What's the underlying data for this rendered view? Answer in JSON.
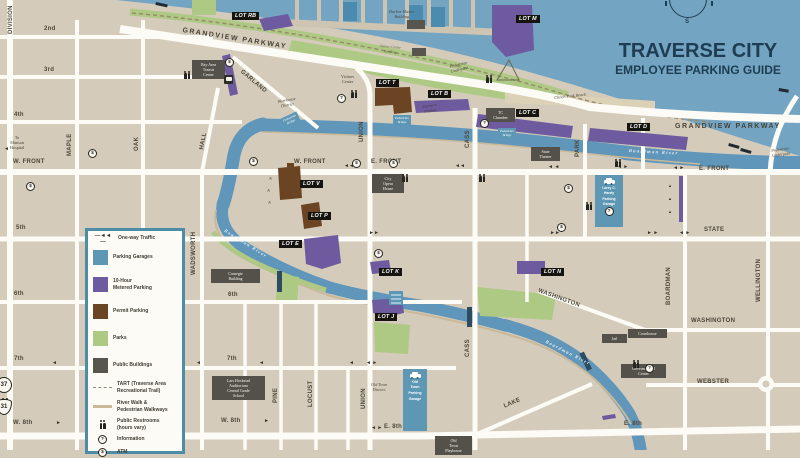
{
  "title": {
    "line1": "TRAVERSE CITY",
    "line2": "EMPLOYEE PARKING GUIDE",
    "compass_south": "S"
  },
  "colors": {
    "land": "#d4cbbb",
    "bay": "#73a4c2",
    "river": "#6096ba",
    "street": "#fcfbf6",
    "parking_garage": "#5d97b4",
    "metered_parking": "#6e5a9e",
    "permit_parking": "#6b4423",
    "park": "#aec983",
    "public_building": "#57554e",
    "lot_label_box": "#15140f",
    "title_text": "#1e3d52",
    "legend_border": "#4d8ca6",
    "river_walk": "#c9b998"
  },
  "legend": {
    "items": [
      {
        "key": "one-way-traffic",
        "lines": [
          "One-way Traffic"
        ],
        "swatch": "glyph",
        "glyph": "—◄◄—",
        "h": 11
      },
      {
        "key": "parking-garages",
        "lines": [
          "Parking Garages"
        ],
        "swatch": "rect",
        "color": "#5d97b4",
        "h": 27
      },
      {
        "key": "metered-parking",
        "lines": [
          "10-Hour",
          "Metered Parking"
        ],
        "swatch": "rect",
        "color": "#6e5a9e",
        "h": 27
      },
      {
        "key": "permit-parking",
        "lines": [
          "Permit Parking"
        ],
        "swatch": "rect",
        "color": "#6b4423",
        "h": 27
      },
      {
        "key": "parks",
        "lines": [
          "Parks"
        ],
        "swatch": "rect",
        "color": "#aec983",
        "h": 27
      },
      {
        "key": "public-buildings",
        "lines": [
          "Public Buildings"
        ],
        "swatch": "rect",
        "color": "#57554e",
        "h": 26
      },
      {
        "key": "tart-trail",
        "lines": [
          "TART (Traverse Area",
          "Recreational Trail)"
        ],
        "swatch": "dash",
        "h": 19
      },
      {
        "key": "river-walk",
        "lines": [
          "River Walk &",
          "Pedestrian Walkways"
        ],
        "swatch": "line",
        "h": 19
      },
      {
        "key": "public-restrooms",
        "lines": [
          "Public Restrooms",
          "(hours vary)"
        ],
        "swatch": "restroom",
        "h": 17
      },
      {
        "key": "information",
        "lines": [
          "Information"
        ],
        "swatch": "info",
        "glyph": "?",
        "h": 13
      },
      {
        "key": "atm",
        "lines": [
          "ATM"
        ],
        "swatch": "atm",
        "glyph": "$",
        "h": 12
      }
    ]
  },
  "map": {
    "icon_glyphs": {
      "info": "?",
      "atm": "$"
    },
    "labels": [
      {
        "n": "street-label-2nd",
        "c": "st",
        "t": "2nd",
        "x": 44,
        "y": 26
      },
      {
        "n": "street-label-3rd",
        "c": "st",
        "t": "3rd",
        "x": 44,
        "y": 67
      },
      {
        "n": "street-label-4th",
        "c": "st",
        "t": "4th",
        "x": 14,
        "y": 112
      },
      {
        "n": "street-label-w-front-left",
        "c": "st",
        "t": "W. FRONT",
        "x": 13,
        "y": 159
      },
      {
        "n": "street-label-w-front",
        "c": "st",
        "t": "W. FRONT",
        "x": 294,
        "y": 159
      },
      {
        "n": "street-label-e-front",
        "c": "st",
        "t": "E. FRONT",
        "x": 371,
        "y": 159
      },
      {
        "n": "street-label-e-front-right",
        "c": "st",
        "t": "E. FRONT",
        "x": 699,
        "y": 166
      },
      {
        "n": "street-label-5th",
        "c": "st",
        "t": "5th",
        "x": 16,
        "y": 225
      },
      {
        "n": "street-label-state",
        "c": "st",
        "t": "STATE",
        "x": 704,
        "y": 227
      },
      {
        "n": "street-label-6th-left",
        "c": "st",
        "t": "6th",
        "x": 14,
        "y": 291
      },
      {
        "n": "street-label-6th",
        "c": "st",
        "t": "6th",
        "x": 228,
        "y": 292
      },
      {
        "n": "street-label-7th-left",
        "c": "st",
        "t": "7th",
        "x": 14,
        "y": 356
      },
      {
        "n": "street-label-7th",
        "c": "st",
        "t": "7th",
        "x": 227,
        "y": 356
      },
      {
        "n": "street-label-w-8th-left",
        "c": "st",
        "t": "W. 8th",
        "x": 13,
        "y": 420
      },
      {
        "n": "street-label-w-8th",
        "c": "st",
        "t": "W. 8th",
        "x": 221,
        "y": 418
      },
      {
        "n": "street-label-e-8th",
        "c": "st",
        "t": "E. 8th",
        "x": 384,
        "y": 424
      },
      {
        "n": "street-label-e-8th-right",
        "c": "st",
        "t": "E. 8th",
        "x": 624,
        "y": 421
      },
      {
        "n": "street-label-grandview-diag",
        "c": "st-lg",
        "t": "GRANDVIEW PARKWAY",
        "x": 183,
        "y": 27,
        "r": 9
      },
      {
        "n": "street-label-grandview-east",
        "c": "st-lg",
        "t": "GRANDVIEW PARKWAY",
        "x": 675,
        "y": 123
      },
      {
        "n": "street-label-garland",
        "c": "st",
        "t": "GARLAND",
        "x": 243,
        "y": 69,
        "r": 40
      },
      {
        "n": "street-label-washington-diag",
        "c": "st",
        "t": "WASHINGTON",
        "x": 539,
        "y": 288,
        "r": 20
      },
      {
        "n": "street-label-washington",
        "c": "st",
        "t": "WASHINGTON",
        "x": 691,
        "y": 318
      },
      {
        "n": "street-label-webster",
        "c": "st",
        "t": "WEBSTER",
        "x": 697,
        "y": 379
      },
      {
        "n": "street-label-lake",
        "c": "st",
        "t": "LAKE",
        "x": 503,
        "y": 404,
        "r": -23
      },
      {
        "n": "street-label-division",
        "c": "st",
        "t": "DIVISION",
        "x": 8,
        "y": 34,
        "r": -90
      },
      {
        "n": "street-label-maple",
        "c": "st",
        "t": "MAPLE",
        "x": 67,
        "y": 156,
        "r": -90
      },
      {
        "n": "street-label-oak",
        "c": "st",
        "t": "OAK",
        "x": 134,
        "y": 151,
        "r": -90
      },
      {
        "n": "street-label-hall",
        "c": "st",
        "t": "HALL",
        "x": 199,
        "y": 149,
        "r": -79
      },
      {
        "n": "street-label-wadsworth",
        "c": "st",
        "t": "WADSWORTH",
        "x": 191,
        "y": 275,
        "r": -90
      },
      {
        "n": "street-label-union-north",
        "c": "st",
        "t": "UNION",
        "x": 359,
        "y": 142,
        "r": -90
      },
      {
        "n": "street-label-union-south",
        "c": "st",
        "t": "UNION",
        "x": 361,
        "y": 409,
        "r": -90
      },
      {
        "n": "street-label-cass-north",
        "c": "st",
        "t": "CASS",
        "x": 465,
        "y": 148,
        "r": -90
      },
      {
        "n": "street-label-cass-south",
        "c": "st",
        "t": "CASS",
        "x": 465,
        "y": 357,
        "r": -90
      },
      {
        "n": "street-label-park",
        "c": "st",
        "t": "PARK",
        "x": 575,
        "y": 157,
        "r": -90
      },
      {
        "n": "street-label-boardman",
        "c": "st",
        "t": "BOARDMAN",
        "x": 666,
        "y": 305,
        "r": -90
      },
      {
        "n": "street-label-wellington",
        "c": "st",
        "t": "WELLINGTON",
        "x": 756,
        "y": 302,
        "r": -90
      },
      {
        "n": "street-label-pine",
        "c": "st",
        "t": "PINE",
        "x": 273,
        "y": 403,
        "r": -90
      },
      {
        "n": "street-label-locust",
        "c": "st",
        "t": "LOCUST",
        "x": 308,
        "y": 407,
        "r": -90
      },
      {
        "n": "lot-rb-label",
        "c": "lot",
        "t": "LOT RB",
        "x": 232,
        "y": 12
      },
      {
        "n": "lot-m-label",
        "c": "lot",
        "t": "LOT M",
        "x": 516,
        "y": 15
      },
      {
        "n": "lot-t-label",
        "c": "lot",
        "t": "LOT T",
        "x": 376,
        "y": 79
      },
      {
        "n": "lot-b-label",
        "c": "lot",
        "t": "LOT B",
        "x": 428,
        "y": 90
      },
      {
        "n": "lot-c-label",
        "c": "lot",
        "t": "LOT C",
        "x": 516,
        "y": 109
      },
      {
        "n": "lot-d-label",
        "c": "lot",
        "t": "LOT D",
        "x": 627,
        "y": 123
      },
      {
        "n": "lot-v-label",
        "c": "lot",
        "t": "LOT V",
        "x": 300,
        "y": 180
      },
      {
        "n": "lot-p-label",
        "c": "lot",
        "t": "LOT P",
        "x": 308,
        "y": 212
      },
      {
        "n": "lot-e-label",
        "c": "lot",
        "t": "LOT E",
        "x": 279,
        "y": 240
      },
      {
        "n": "lot-k-label",
        "c": "lot",
        "t": "LOT K",
        "x": 379,
        "y": 268
      },
      {
        "n": "lot-j-label",
        "c": "lot",
        "t": "LOT J",
        "x": 375,
        "y": 313
      },
      {
        "n": "lot-n-label",
        "c": "lot",
        "t": "LOT N",
        "x": 541,
        "y": 268
      },
      {
        "n": "bay-area-transit-center",
        "c": "bld",
        "l": [
          "Bay Area",
          "Transit",
          "Center"
        ],
        "x": 192,
        "y": 60,
        "w": 31
      },
      {
        "n": "tc-chamber",
        "c": "bld",
        "l": [
          "TC",
          "Chamber"
        ],
        "x": 486,
        "y": 108,
        "w": 27
      },
      {
        "n": "state-theater",
        "c": "bld",
        "l": [
          "State",
          "Theater"
        ],
        "x": 531,
        "y": 147,
        "w": 27
      },
      {
        "n": "city-opera-house",
        "c": "bld",
        "l": [
          "City",
          "Opera",
          "House"
        ],
        "x": 372,
        "y": 174,
        "w": 30
      },
      {
        "n": "carnegie-building",
        "c": "bld",
        "l": [
          "Carnegie",
          "Building"
        ],
        "x": 211,
        "y": 269,
        "w": 47
      },
      {
        "n": "lars-hockstad-auditorium",
        "c": "bld",
        "l": [
          "Lars Hockstad",
          "Auditorium",
          " ",
          "Central Grade",
          "School"
        ],
        "x": 212,
        "y": 376,
        "w": 51
      },
      {
        "n": "jail",
        "c": "bld",
        "l": [
          "Jail"
        ],
        "x": 602,
        "y": 334,
        "w": 23
      },
      {
        "n": "courthouse",
        "c": "bld",
        "l": [
          "Courthouse"
        ],
        "x": 628,
        "y": 329,
        "w": 37
      },
      {
        "n": "governmental-center",
        "c": "bld",
        "l": [
          "Governmental",
          "Center"
        ],
        "x": 621,
        "y": 364,
        "w": 43
      },
      {
        "n": "old-town-playhouse",
        "c": "bld",
        "l": [
          "Old",
          "Town",
          "Playhouse"
        ],
        "x": 435,
        "y": 436,
        "w": 35
      },
      {
        "n": "larry-hardy-parking-garage",
        "c": "garage",
        "l": [
          "Larry C.",
          "Hardy",
          "Parking Garage"
        ],
        "x": 595,
        "y": 175,
        "w": 26,
        "h": 47,
        "car": true,
        "info": true
      },
      {
        "n": "old-town-parking-garage",
        "c": "garage",
        "l": [
          "Old",
          "Town",
          "Parking",
          "Garage"
        ],
        "x": 403,
        "y": 369,
        "w": 22,
        "h": 57,
        "car": true
      },
      {
        "n": "harbor-master-building",
        "c": "area",
        "l": [
          "Harbor Master",
          "Building"
        ],
        "x": 389,
        "y": 9
      },
      {
        "n": "senior-center-building",
        "c": "area parkl",
        "l": [
          "Senior Center",
          "Building"
        ],
        "x": 380,
        "y": 44,
        "r": 5
      },
      {
        "n": "visitors-center",
        "c": "tiny",
        "l": [
          "Visitors",
          "Center"
        ],
        "x": 341,
        "y": 74
      },
      {
        "n": "warehouse-district",
        "c": "area",
        "l": [
          "Warehouse",
          "District"
        ],
        "x": 277,
        "y": 99,
        "r": -10
      },
      {
        "n": "farmers-market",
        "c": "area",
        "l": [
          "Farmers",
          "Market"
        ],
        "x": 422,
        "y": 104,
        "r": -8
      },
      {
        "n": "old-town-district",
        "c": "area",
        "l": [
          "Old Town",
          "District"
        ],
        "x": 371,
        "y": 382
      },
      {
        "n": "pedestrian-underpass-park",
        "c": "area",
        "l": [
          "Pedestrian",
          "Underpass"
        ],
        "x": 449,
        "y": 64,
        "r": -13
      },
      {
        "n": "pedestrian-underpass-east",
        "c": "area",
        "l": [
          "Pedestrian",
          "Underpass"
        ],
        "x": 771,
        "y": 148,
        "r": -8
      },
      {
        "n": "clinch-park-beach",
        "c": "area",
        "l": [
          "Clinch Park Beach"
        ],
        "x": 554,
        "y": 95,
        "r": -6
      },
      {
        "n": "to-munson-hospital",
        "c": "tiny",
        "l": [
          "To",
          "Munson",
          "Hospital"
        ],
        "x": 10,
        "y": 135
      },
      {
        "n": "boardman-river-label-east",
        "c": "river",
        "t": "Boardman River",
        "x": 629,
        "y": 148,
        "r": 3
      },
      {
        "n": "boardman-river-label-west",
        "c": "river",
        "t": "Boardman River",
        "x": 226,
        "y": 228,
        "r": 32
      },
      {
        "n": "boardman-river-label-south",
        "c": "river",
        "t": "Boardman River",
        "x": 547,
        "y": 339,
        "r": 27
      },
      {
        "n": "pedestrian-bridge-1",
        "c": "bridge",
        "l": [
          "Pedestrian",
          "Bridge"
        ],
        "x": 280,
        "y": 119,
        "r": -25
      },
      {
        "n": "pedestrian-bridge-2",
        "c": "bridge",
        "l": [
          "Pedestrian",
          "Bridge"
        ],
        "x": 393,
        "y": 115
      },
      {
        "n": "pedestrian-bridge-3",
        "c": "bridge",
        "l": [
          "Pedestrian",
          "Bridge"
        ],
        "x": 498,
        "y": 128
      }
    ],
    "arrows": [
      {
        "g": "◄◄",
        "x": 344,
        "y": 164
      },
      {
        "g": "◄◄",
        "x": 455,
        "y": 164
      },
      {
        "g": "◄ ◄",
        "x": 548,
        "y": 165
      },
      {
        "g": "◄ ►",
        "x": 617,
        "y": 165
      },
      {
        "g": "◄ ►",
        "x": 673,
        "y": 166
      },
      {
        "g": "►►",
        "x": 369,
        "y": 231
      },
      {
        "g": "►►",
        "x": 550,
        "y": 231
      },
      {
        "g": "► ►",
        "x": 647,
        "y": 231
      },
      {
        "g": "◄ ►",
        "x": 679,
        "y": 231
      },
      {
        "g": "◄",
        "x": 52,
        "y": 361
      },
      {
        "g": "◄",
        "x": 196,
        "y": 361
      },
      {
        "g": "◄",
        "x": 259,
        "y": 361
      },
      {
        "g": "◄",
        "x": 349,
        "y": 361
      },
      {
        "g": "◄ ►",
        "x": 366,
        "y": 361
      },
      {
        "g": "►",
        "x": 56,
        "y": 421
      },
      {
        "g": "►",
        "x": 264,
        "y": 419
      },
      {
        "g": "◄ ►",
        "x": 371,
        "y": 426
      },
      {
        "g": "▲",
        "x": 668,
        "y": 184,
        "s": 4
      },
      {
        "g": "▲",
        "x": 668,
        "y": 197,
        "s": 4
      },
      {
        "g": "▲",
        "x": 668,
        "y": 210,
        "s": 4
      },
      {
        "g": "«",
        "x": 272,
        "y": 177,
        "r": 90
      },
      {
        "g": "«",
        "x": 270,
        "y": 189,
        "r": 90
      },
      {
        "g": "«",
        "x": 271,
        "y": 201,
        "r": 90
      },
      {
        "g": "◄",
        "x": 4,
        "y": 147
      }
    ],
    "icons": [
      {
        "k": "restroom",
        "x": 184,
        "y": 66
      },
      {
        "k": "restroom",
        "x": 351,
        "y": 85
      },
      {
        "k": "restroom",
        "x": 402,
        "y": 169
      },
      {
        "k": "restroom",
        "x": 479,
        "y": 169
      },
      {
        "k": "restroom",
        "x": 615,
        "y": 154
      },
      {
        "k": "restroom",
        "x": 586,
        "y": 197
      },
      {
        "k": "restroom",
        "x": 633,
        "y": 355
      },
      {
        "k": "restroom",
        "x": 486,
        "y": 70
      },
      {
        "k": "restroom",
        "x": 2,
        "y": 393
      },
      {
        "k": "info",
        "x": 337,
        "y": 86
      },
      {
        "k": "info",
        "x": 480,
        "y": 111
      },
      {
        "k": "info",
        "x": 645,
        "y": 356
      },
      {
        "k": "atm",
        "x": 26,
        "y": 174
      },
      {
        "k": "atm",
        "x": 88,
        "y": 141
      },
      {
        "k": "atm",
        "x": 249,
        "y": 149
      },
      {
        "k": "atm",
        "x": 352,
        "y": 151
      },
      {
        "k": "atm",
        "x": 389,
        "y": 151
      },
      {
        "k": "atm",
        "x": 225,
        "y": 50
      },
      {
        "k": "atm",
        "x": 564,
        "y": 176
      },
      {
        "k": "atm",
        "x": 557,
        "y": 215
      },
      {
        "k": "atm",
        "x": 374,
        "y": 241
      },
      {
        "k": "bus",
        "x": 224,
        "y": 68
      }
    ],
    "shields": [
      {
        "shape": "circle",
        "text": "37",
        "x": -4,
        "y": 377
      },
      {
        "shape": "shield",
        "text": "31",
        "x": -4,
        "y": 399
      }
    ]
  }
}
